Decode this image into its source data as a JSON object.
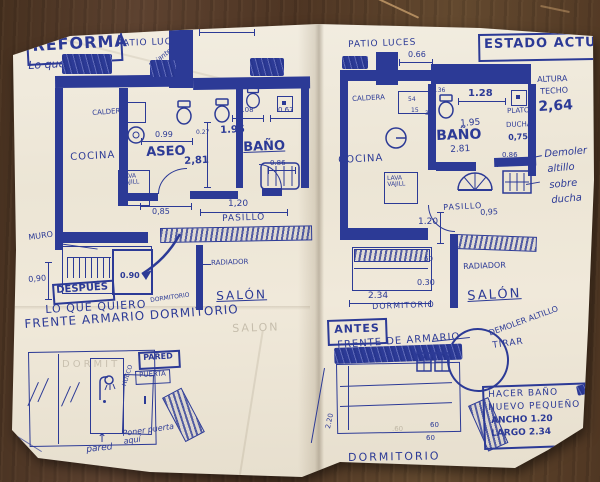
{
  "colors": {
    "ink": "#2c3a96",
    "paper": "#efe9dc",
    "wood": "#5a3c2a",
    "pencil": "#a59c89"
  },
  "reforma": {
    "title": "REFORMA",
    "subtitle": "Lo que quiero",
    "patio": "PATIO LUCES",
    "bajante": "bajante",
    "cocina": "COCINA",
    "aseo": "ASEO",
    "bano": "BAÑO",
    "pasillo": "PASILLO",
    "salon": "SALÓN",
    "salon_pencil": "SALON",
    "dormitorio": "DORMITORIO",
    "caldera": "CALDERA",
    "lava1": "LAVA",
    "lava2": "VAJILL",
    "muro": "MURO",
    "radiador": "RADIADOR",
    "dim_top": "1.20",
    "dim_aseo_w": "0.99",
    "dim_small": "0.27",
    "dim_bano_w": "1.95",
    "dim_bano_top": "1.08",
    "dim_window": "0.67",
    "dim_depth": "2,81",
    "dim_tub": "0.86",
    "dim_pas1": "0,85",
    "dim_pas2": "1,20",
    "dim_muro": "0,90",
    "dim_closet": "0.90"
  },
  "actual": {
    "title": "ESTADO ACTUAL",
    "patio": "PATIO LUCES",
    "dim_patio": "0.66",
    "cocina": "COCINA",
    "bano": "BAÑO",
    "pasillo": "PASILLO",
    "salon": "SALÓN",
    "dormitorio": "DORMITORIO",
    "caldera": "CALDERA",
    "lava1": "LAVA",
    "lava2": "VAJILL",
    "radiador": "RADIADOR",
    "plato": "PLATO",
    "ducha": "DUCHA",
    "dim_plato": "0,75",
    "dim_wc1": "0.36",
    "dim_wc2": "54",
    "dim_wc3": "15",
    "dim_wc4": "30",
    "dim_bano_top": "1.28",
    "dim_bano_w": "1.95",
    "dim_depth": "2.81",
    "dim_tub": "0.86",
    "dim_pasillo": "0,95",
    "dim_pass_v": "1.20",
    "dim_60": "60",
    "dim_030": "0.30",
    "dim_dorm": "2.34",
    "altura1": "ALTURA",
    "altura2": "TECHO",
    "altura_val": "2,64",
    "demoler1": "Demoler",
    "demoler2": "altillo",
    "demoler3": "sobre",
    "demoler4": "ducha"
  },
  "despues": {
    "tag": "DESPUÉS",
    "line1": "LO QUE QUIERO",
    "line2": "FRENTE ARMARIO DORMITORIO",
    "pared_box": "PARED",
    "puerta_box": "PUERTA",
    "hueco": "HUECO",
    "nota": "Poner puerta aquí",
    "pared": "pared",
    "arrow_up": "↑",
    "pencil": "DORMIT"
  },
  "antes": {
    "tag": "ANTES",
    "line1": "FRENTE DE ARMARIO",
    "demoler": "DEMOLER ALTILLO",
    "tirar": "TIRAR",
    "nota1": "HACER BAÑO",
    "nota2": "NUEVO PEQUEÑO",
    "nota3": "ANCHO 1.20",
    "nota4": "LARGO 2.34",
    "dormitorio": "DORMITORIO",
    "dim_alto": "2.20",
    "dim_a": "60",
    "dim_b": "60",
    "dim_pencil": ".60"
  }
}
